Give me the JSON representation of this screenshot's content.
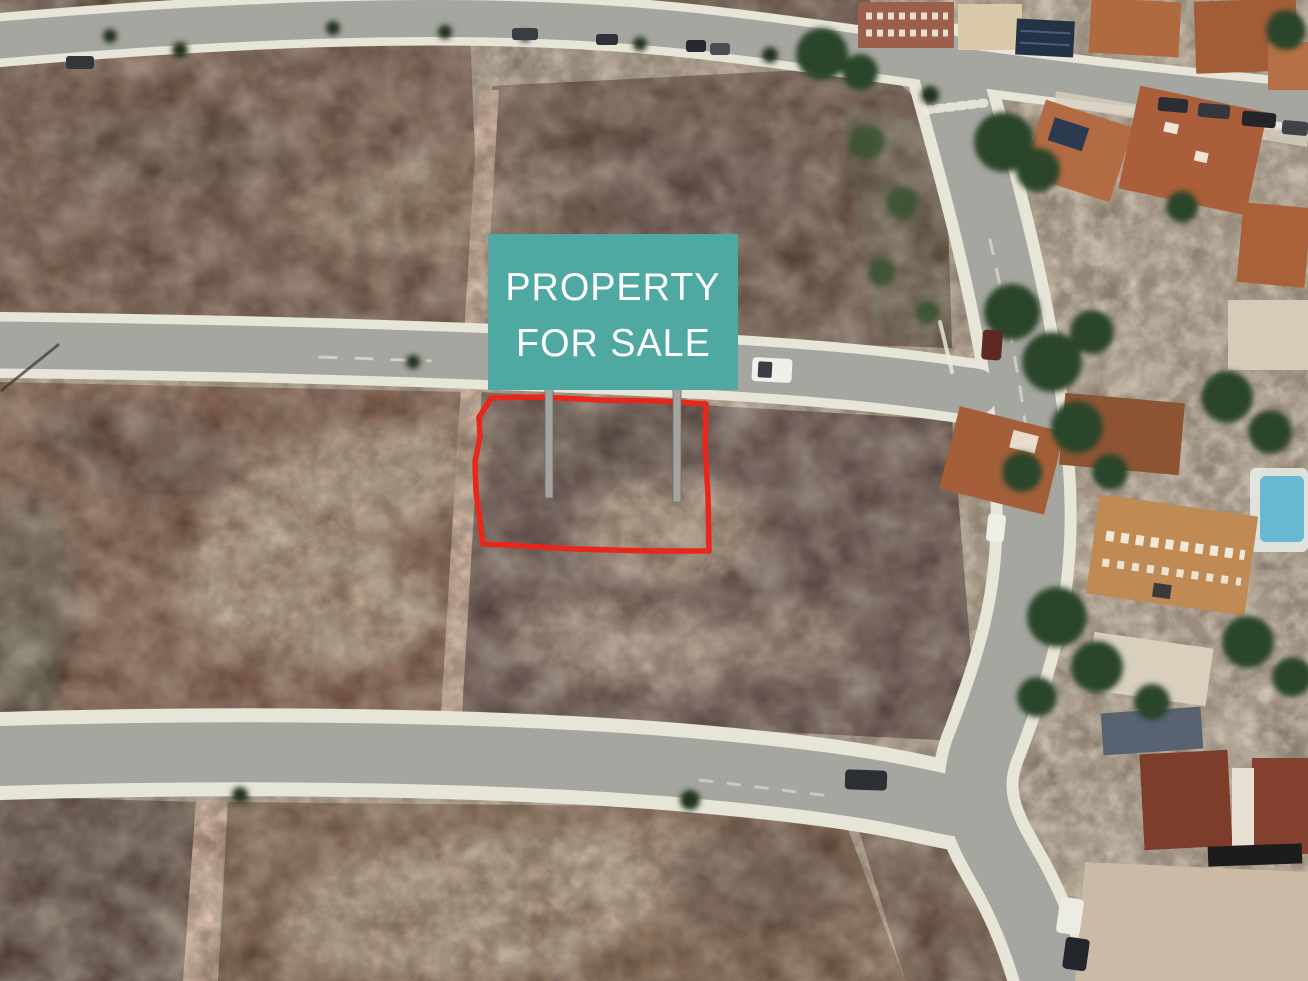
{
  "scene": {
    "kind": "aerial-satellite-photo",
    "subject": "vacant land plots beside a residential neighbourhood"
  },
  "sign": {
    "line1": "PROPERTY",
    "line2": "FOR SALE",
    "background_color": "#4FA9A2",
    "text_color": "#FFFFFF",
    "post_count": "2"
  },
  "boundary": {
    "outline_color": "#E7261C"
  },
  "colors": {
    "asphalt": "#a6a6a0",
    "curb": "#e7e4d8",
    "soil_dark": "#564243",
    "soil_red": "#7b5140",
    "path_pink": "#eac4ae",
    "roof_terracotta": "#aa5f3a",
    "tree_green": "#2f4a2c",
    "pool_blue": "#67b8d2",
    "post_gray": "#a3a3a0"
  }
}
